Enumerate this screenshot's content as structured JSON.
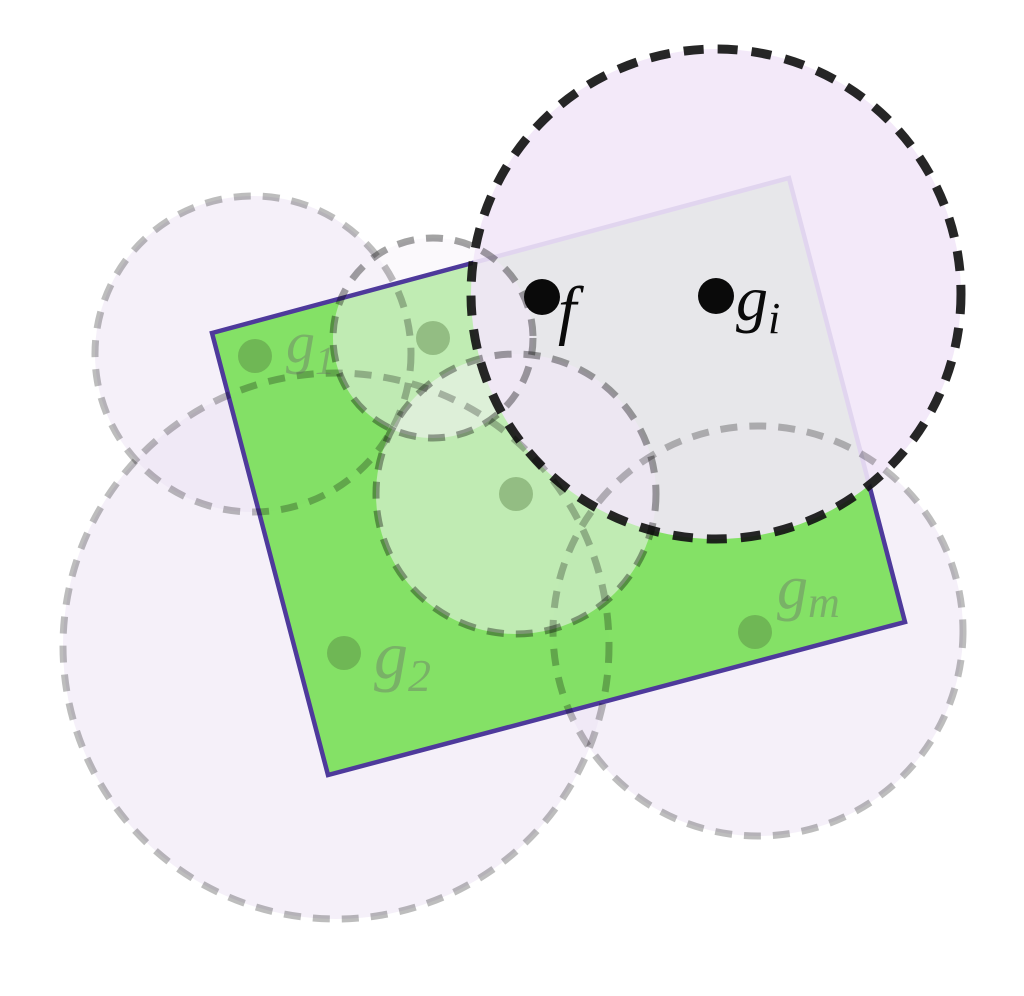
{
  "canvas": {
    "width": 1024,
    "height": 996,
    "background": "#ffffff"
  },
  "rect": {
    "points": "212,333 789,178 905,622 328,775",
    "fill": "rgba(112,222,76,0.85)",
    "stroke": "#4e3a9b",
    "stroke_width": 4.5
  },
  "balls": {
    "back": [
      {
        "id": "ball-g1",
        "cx": 253,
        "cy": 354,
        "r": 158
      },
      {
        "id": "ball-g2",
        "cx": 336,
        "cy": 646,
        "r": 273
      },
      {
        "id": "ball-gm",
        "cx": 758,
        "cy": 631,
        "r": 205
      }
    ],
    "front": [
      {
        "id": "ball-upper-mid",
        "cx": 433,
        "cy": 338,
        "r": 100
      },
      {
        "id": "ball-center",
        "cx": 516,
        "cy": 494,
        "r": 140
      }
    ],
    "highlight": {
      "id": "ball-gi",
      "cx": 716,
      "cy": 294,
      "r": 245
    }
  },
  "styles": {
    "back_fill": "rgba(236,226,243,0.5)",
    "back_stroke": "rgba(0,0,0,0.26)",
    "front_fill": "rgba(247,244,250,0.52)",
    "front_stroke": "rgba(0,0,0,0.36)",
    "highlight_fill": "rgba(242,231,248,0.9)",
    "highlight_stroke": "rgba(20,20,20,0.92)",
    "green_point": "rgba(80,120,60,0.4)",
    "black_point": "#0a0a0a",
    "green_label": "rgba(105,105,105,0.4)",
    "black_label": "#0a0a0a"
  },
  "points": [
    {
      "id": "point-g1",
      "cx": 255,
      "cy": 356,
      "r": 17,
      "fill": "rgba(80,120,60,0.4)"
    },
    {
      "id": "point-upper-mid",
      "cx": 433,
      "cy": 338,
      "r": 17,
      "fill": "rgba(80,120,60,0.4)"
    },
    {
      "id": "point-center",
      "cx": 516,
      "cy": 494,
      "r": 17,
      "fill": "rgba(80,120,60,0.4)"
    },
    {
      "id": "point-g2",
      "cx": 344,
      "cy": 653,
      "r": 17,
      "fill": "rgba(80,120,60,0.4)"
    },
    {
      "id": "point-gm",
      "cx": 755,
      "cy": 632,
      "r": 17,
      "fill": "rgba(80,120,60,0.4)"
    },
    {
      "id": "point-f",
      "cx": 542,
      "cy": 297,
      "r": 18,
      "fill": "#0a0a0a"
    },
    {
      "id": "point-gi",
      "cx": 716,
      "cy": 296,
      "r": 18,
      "fill": "#0a0a0a"
    }
  ],
  "labels": [
    {
      "id": "label-g1",
      "main": "g",
      "sub": "1",
      "x": 286,
      "y": 362,
      "size": 58,
      "sub_size": 40,
      "fill": "rgba(105,105,105,0.4)"
    },
    {
      "id": "label-g2",
      "main": "g",
      "sub": "2",
      "x": 374,
      "y": 678,
      "size": 68,
      "sub_size": 46,
      "fill": "rgba(105,105,105,0.4)"
    },
    {
      "id": "label-gm",
      "main": "g",
      "sub": "m",
      "x": 777,
      "y": 608,
      "size": 62,
      "sub_size": 44,
      "fill": "rgba(105,105,105,0.4)"
    },
    {
      "id": "label-f",
      "main": "f",
      "sub": "",
      "x": 558,
      "y": 332,
      "size": 66,
      "sub_size": 44,
      "fill": "#0a0a0a"
    },
    {
      "id": "label-gi",
      "main": "g",
      "sub": "i",
      "x": 736,
      "y": 320,
      "size": 64,
      "sub_size": 44,
      "fill": "#0a0a0a"
    }
  ]
}
